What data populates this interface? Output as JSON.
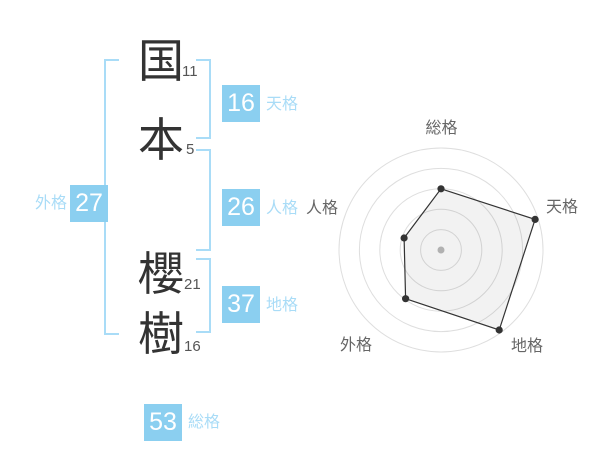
{
  "name": {
    "chars": [
      {
        "char": "国",
        "strokes": "11"
      },
      {
        "char": "本",
        "strokes": "5"
      },
      {
        "char": "櫻",
        "strokes": "21"
      },
      {
        "char": "樹",
        "strokes": "16"
      }
    ]
  },
  "gokaku": {
    "tenkaku": {
      "value": "16",
      "label": "天格"
    },
    "jinkaku": {
      "value": "26",
      "label": "人格"
    },
    "chikaku": {
      "value": "37",
      "label": "地格"
    },
    "gaikaku": {
      "value": "27",
      "label": "外格"
    },
    "soukaku": {
      "value": "53",
      "label": "総格"
    }
  },
  "colors": {
    "badge_blue": "#8bcff0",
    "label_blue": "#a9dcf7",
    "bracket_blue": "#a9dcf7",
    "kanji_dark": "#333333",
    "stroke_number_gray": "#555555",
    "chart_ring_gray": "#dedede",
    "chart_line_dark": "#333333",
    "chart_fill": "rgba(0,0,0,0.05)",
    "chart_label_gray": "#666666",
    "center_dot_gray": "#bbbbbb"
  },
  "chart_data": {
    "type": "radar",
    "title": "",
    "categories": [
      "総格",
      "天格",
      "地格",
      "外格",
      "人格"
    ],
    "values": [
      60,
      97,
      97,
      59,
      38
    ],
    "value_range": [
      0,
      100
    ],
    "rings": 5,
    "grid": "circular",
    "legend": "none",
    "start_axis": "top",
    "direction": "clockwise"
  }
}
